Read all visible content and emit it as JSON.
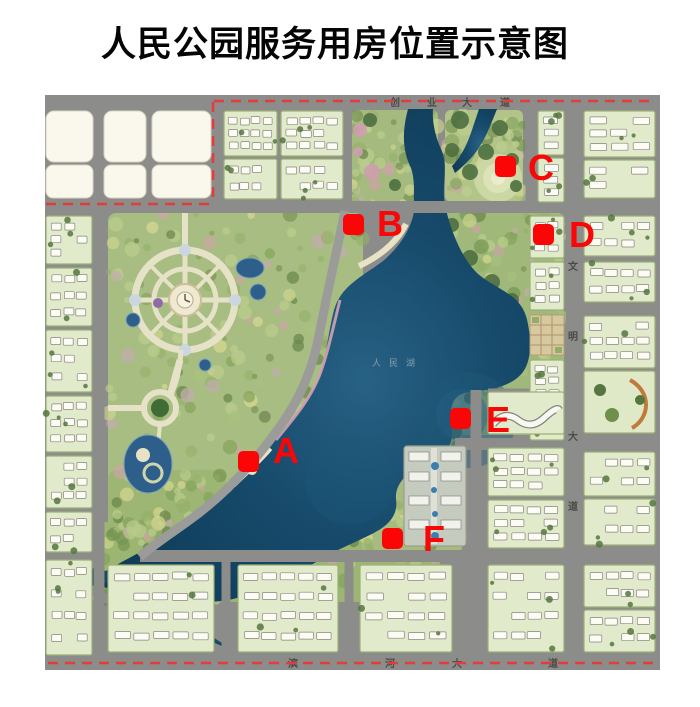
{
  "title": "人民公园服务用房位置示意图",
  "map": {
    "markers": [
      {
        "label": "A"
      },
      {
        "label": "B"
      },
      {
        "label": "C"
      },
      {
        "label": "D"
      },
      {
        "label": "E"
      },
      {
        "label": "F"
      }
    ],
    "road_labels": {
      "top": {
        "name": "创业大道",
        "chars": [
          "创",
          "业",
          "大",
          "道"
        ]
      },
      "right": {
        "name": "文明大道",
        "chars": [
          "文",
          "明",
          "大",
          "道"
        ]
      },
      "bottom": {
        "name": "滨河大道",
        "chars": [
          "滨",
          "河",
          "大",
          "道"
        ]
      }
    },
    "lake_label": "人民湖",
    "colors": {
      "marker": "#fb0606",
      "boundary_dash": "#e23c3c",
      "road": "#8c8c8a",
      "block": "#e1eaca",
      "white_block": "#faf8ec",
      "park": "#a8bd81",
      "lake_deep": "#0e3a55"
    }
  }
}
